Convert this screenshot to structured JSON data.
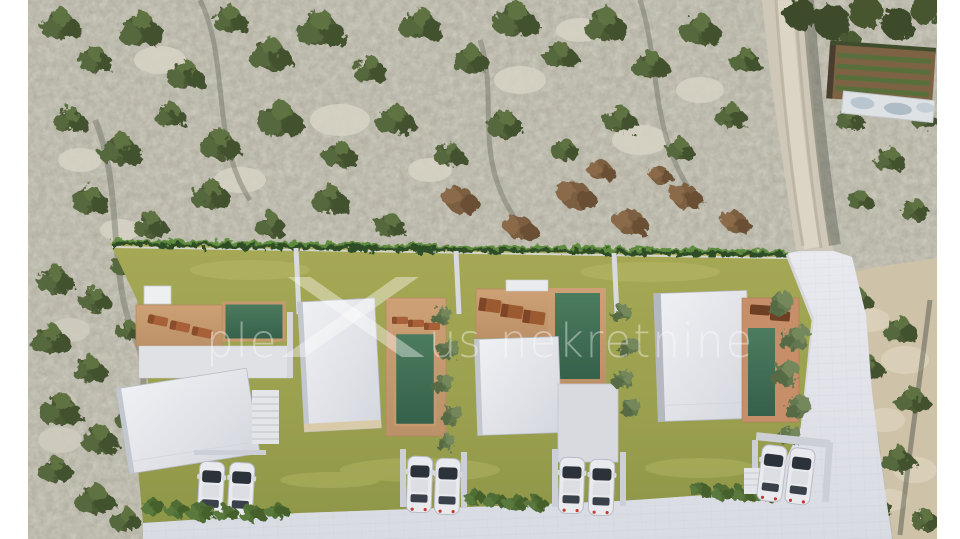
{
  "watermark": {
    "part1": "ple",
    "part2": "us",
    "part3": "nekretnine",
    "full_text": "plexus nekretnine"
  },
  "scene": {
    "villas_count": 4,
    "pools_count": 4,
    "parked_cars_count": 8,
    "colors": {
      "pool_water": "#3e6b52",
      "lawn": "#9aa04e",
      "wood_deck": "#c69a6e",
      "roof": "#e7e8ec",
      "street": "#e1e2e9",
      "terrain_rock": "#b5b1a4",
      "shrub_green": "#4c5a34",
      "dirt_road": "#cfc8b8",
      "frame": "#ffffff"
    }
  }
}
